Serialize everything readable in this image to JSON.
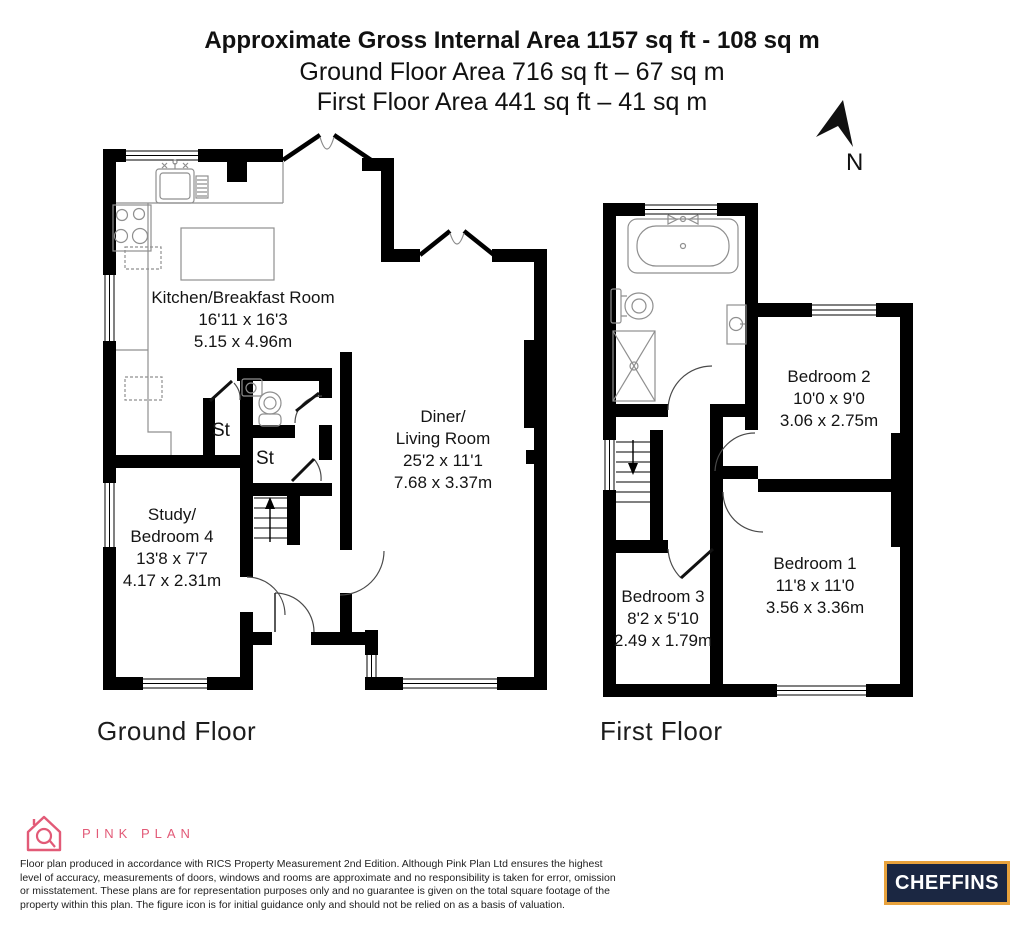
{
  "header": {
    "title": "Approximate Gross Internal Area 1157 sq ft - 108 sq m",
    "subtitle_ground": "Ground Floor Area 716 sq ft – 67 sq m",
    "subtitle_first": "First Floor Area 441 sq ft – 41 sq m"
  },
  "compass": {
    "label": "N"
  },
  "ground_floor": {
    "caption": "Ground Floor",
    "kitchen": {
      "name": "Kitchen/Breakfast Room",
      "imperial": "16'11 x 16'3",
      "metric": "5.15 x 4.96m"
    },
    "diner": {
      "name1": "Diner/",
      "name2": "Living Room",
      "imperial": "25'2 x 11'1",
      "metric": "7.68 x 3.37m"
    },
    "study": {
      "name1": "Study/",
      "name2": "Bedroom 4",
      "imperial": "13'8 x 7'7",
      "metric": "4.17 x 2.31m"
    },
    "store1": {
      "name": "St"
    },
    "store2": {
      "name": "St"
    }
  },
  "first_floor": {
    "caption": "First Floor",
    "bedroom1": {
      "name": "Bedroom 1",
      "imperial": "11'8 x 11'0",
      "metric": "3.56 x 3.36m"
    },
    "bedroom2": {
      "name": "Bedroom 2",
      "imperial": "10'0 x 9'0",
      "metric": "3.06 x 2.75m"
    },
    "bedroom3": {
      "name": "Bedroom 3",
      "imperial": "8'2 x 5'10",
      "metric": "2.49 x 1.79m"
    }
  },
  "footer": {
    "pinkplan_brand": "PINK PLAN",
    "disclaimer_lines": [
      "Floor plan produced in accordance with RICS Property Measurement 2nd Edition. Although Pink Plan Ltd ensures the highest",
      "level of accuracy, measurements of doors, windows and rooms are approximate and no responsibility is taken for error, omission",
      "or misstatement. These plans are for representation purposes only and no guarantee is given on the total square footage of the",
      "property within this plan. The figure icon is for initial guidance only and should not be relied on as a basis of valuation."
    ],
    "cheffins_brand": "CHEFFINS"
  },
  "colors": {
    "pink": "#e25a77",
    "cheffins_navy": "#1b2742",
    "cheffins_gold": "#e8a23c",
    "wall": "#000000"
  }
}
